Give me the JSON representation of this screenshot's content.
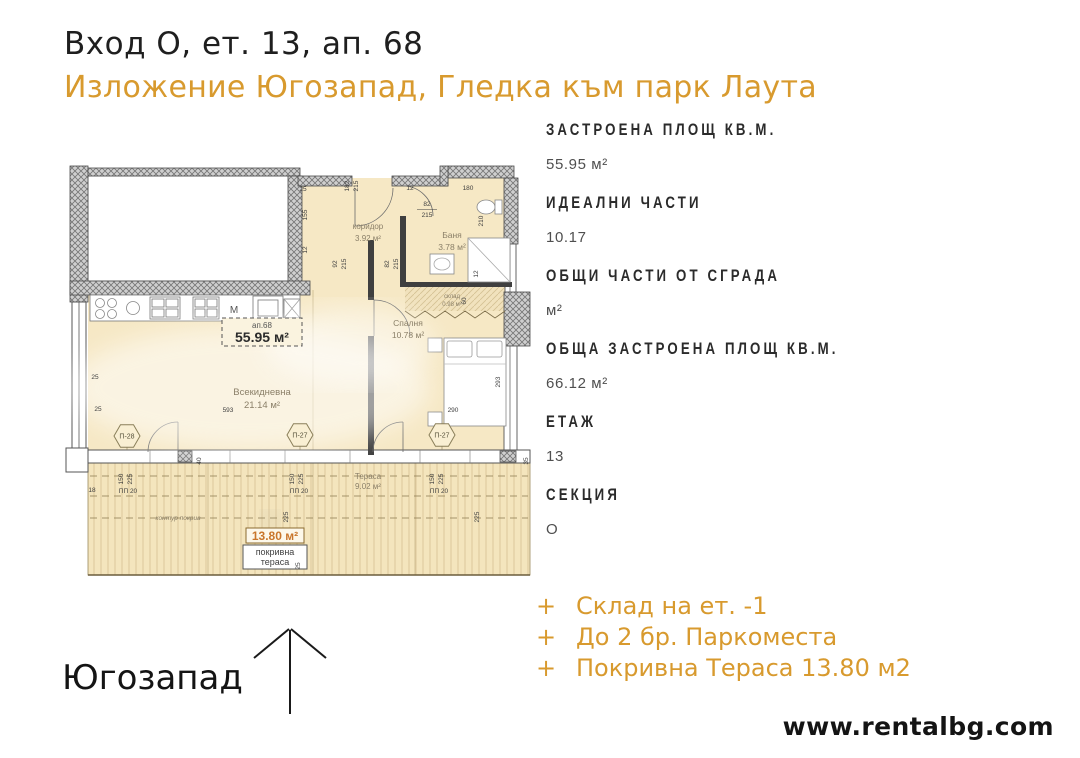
{
  "colors": {
    "accent": "#d89a2e",
    "plan_floor": "#f6e8c5",
    "roof_area_orange": "#c9762b"
  },
  "header": {
    "title": "Вход О, ет. 13, ап. 68",
    "subtitle": "Изложение Югозапад, Гледка към парк Лаута"
  },
  "details": {
    "items": [
      {
        "label": "ЗАСТРОЕНА ПЛОЩ КВ.М.",
        "value": "55.95 м²"
      },
      {
        "label": "ИДЕАЛНИ ЧАСТИ",
        "value": "10.17"
      },
      {
        "label": "ОБЩИ ЧАСТИ ОТ СГРАДА",
        "value": "м²"
      },
      {
        "label": "ОБЩА ЗАСТРОЕНА ПЛОЩ КВ.М.",
        "value": "66.12 м²"
      },
      {
        "label": "ЕТАЖ",
        "value": "13"
      },
      {
        "label": "СЕКЦИЯ",
        "value": "О"
      }
    ]
  },
  "features": {
    "bullet": "+",
    "items": [
      "Склад на ет. -1",
      "До 2 бр. Паркоместа",
      "Покривна Тераса 13.80 м2"
    ]
  },
  "compass": {
    "direction": "Югозапад"
  },
  "footer": {
    "website": "www.rentalbg.com"
  },
  "floorplan": {
    "unit": {
      "id": "ап.68",
      "area": "55.95 м²"
    },
    "rooms": {
      "corridor": {
        "name": "коридор",
        "area": "3.92 м²"
      },
      "bath": {
        "name": "Баня",
        "area": "3.78 м²"
      },
      "storage": {
        "name": "склад",
        "area": "0.98 м²"
      },
      "bedroom": {
        "name": "Спалня",
        "area": "10.78 м²"
      },
      "living": {
        "name": "Всекидневна",
        "area": "21.14 м²"
      },
      "terrace": {
        "name": "Тераса",
        "area": "9.02 м²"
      },
      "roof_terrace": {
        "area": "13.80 м²",
        "name_line1": "покривна",
        "name_line2": "тераса"
      }
    },
    "marks": {
      "hex1": "П-28",
      "hex2": "П-27",
      "hex3": "П-27",
      "kitchen_m": "М",
      "roof_contour": "контур покрив"
    },
    "dims": {
      "d12": "12",
      "d18": "18",
      "d25": "25",
      "d35": "35",
      "d40": "40",
      "d60": "60",
      "d82": "82",
      "d92": "92",
      "d150": "150",
      "d155": "155",
      "d180": "180",
      "d182": "182",
      "d210": "210",
      "d215": "215",
      "d225": "225",
      "d290": "290",
      "d293": "293",
      "d593": "593",
      "pp20": "ПП 20"
    }
  }
}
